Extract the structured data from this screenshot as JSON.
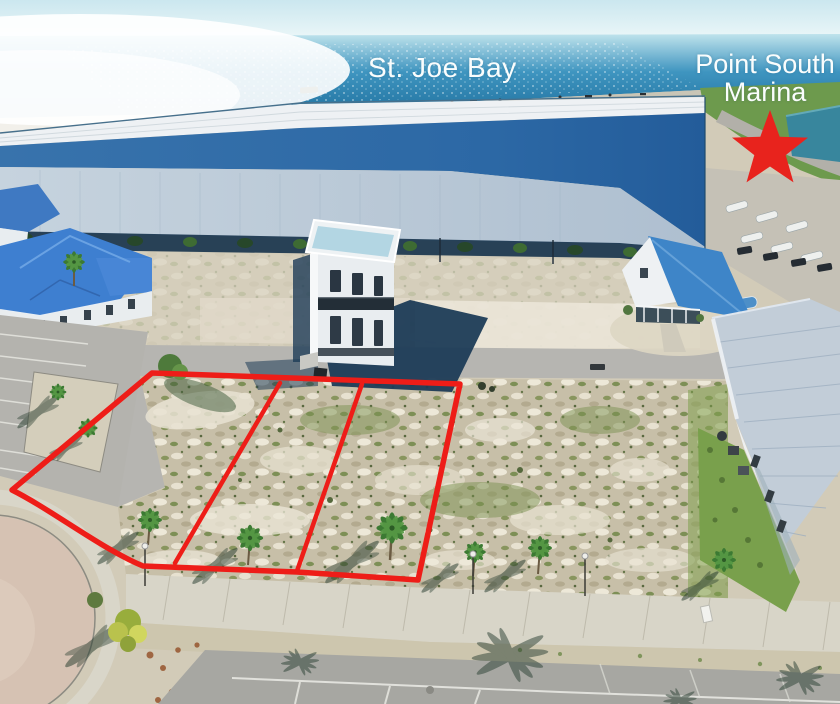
{
  "scene": {
    "labels": {
      "bay": "St. Joe Bay",
      "marina_line1": "Point South",
      "marina_line2": "Marina"
    },
    "annotations": {
      "outlined_lots": 3,
      "lot_outline_color": "#ee1d18",
      "star_color": "#e8231d",
      "label_color": "#fafdfd"
    }
  }
}
